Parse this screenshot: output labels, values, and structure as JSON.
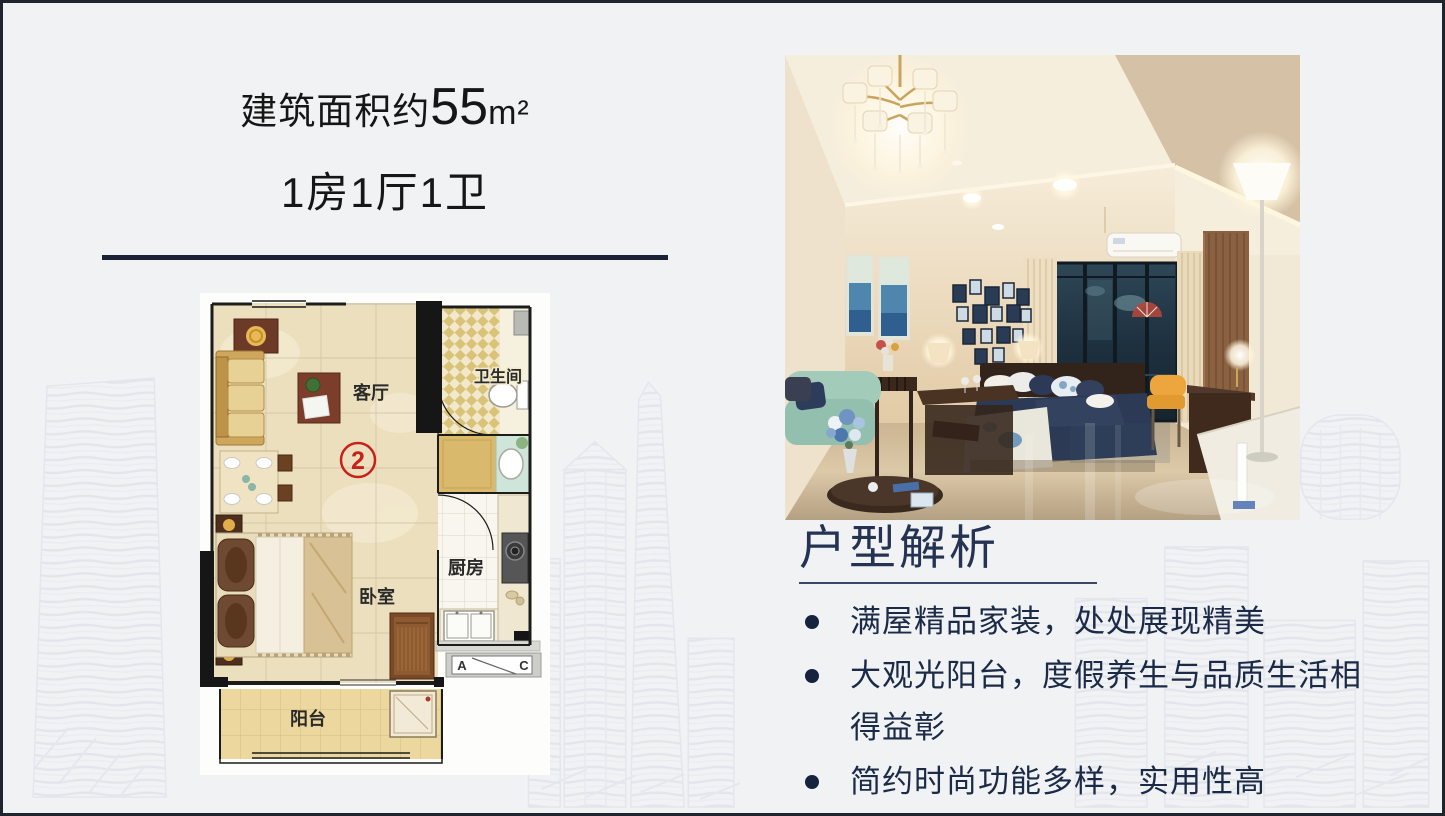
{
  "header": {
    "area_prefix": "建筑面积约",
    "area_value": "55",
    "area_unit": "m²",
    "layout": "1房1厅1卫"
  },
  "floorplan": {
    "living_room": "客厅",
    "bathroom": "卫生间",
    "kitchen": "厨房",
    "bedroom": "卧室",
    "balcony": "阳台",
    "unit_mark": "2",
    "ac_left": "A",
    "ac_right": "C"
  },
  "analysis": {
    "heading": "户型解析",
    "bullets": [
      "满屋精品家装，处处展现精美",
      "大观光阳台，度假养生与品质生活相得益彰",
      "简约时尚功能多样，实用性高"
    ]
  },
  "colors": {
    "slide_background": "#f1f2f4",
    "frame_navy": "#20242e",
    "divider_navy": "#1b2236",
    "heading_navy": "#243352",
    "bullet_navy": "#15233e",
    "floorplan_marble": "#ecdfbd",
    "floorplan_mark_red": "#c8211a",
    "sketch_gray": "#e3e6ec"
  }
}
